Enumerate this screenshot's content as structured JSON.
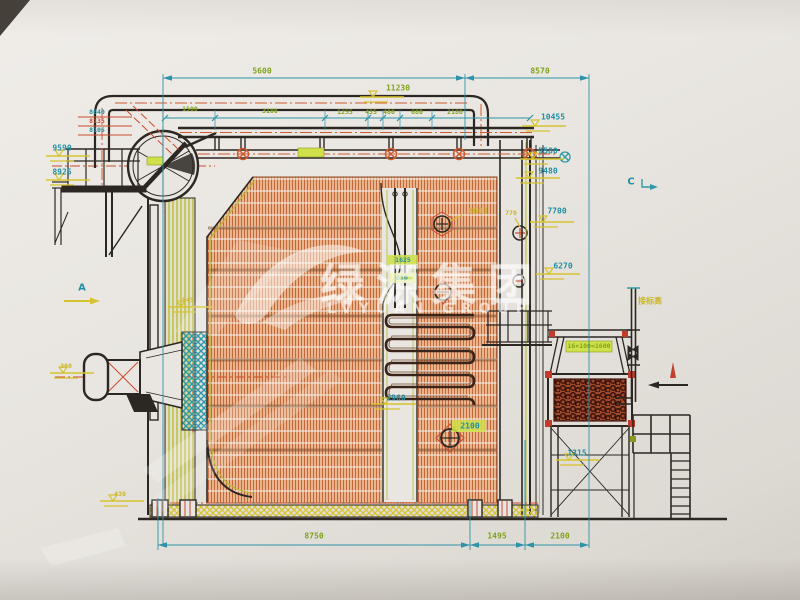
{
  "document": {
    "kind": "engineering-cad-drawing-photo",
    "subject": "boiler side elevation drawing"
  },
  "watermark": {
    "logo": "swoosh-logo",
    "cn": "绿源集团",
    "en": "LVYUAN GROUP"
  },
  "colors": {
    "paper": "#e9e6e1",
    "line_dark": "#2c2722",
    "teal": "#1f8fa3",
    "green": "#7fa31c",
    "yellow": "#c9b62a",
    "red": "#cc4b2e",
    "tube_orange": "#e8b58d",
    "tube_stroke": "#c4683c",
    "coil_dark": "#40120a",
    "olive": "#b5ba30"
  },
  "annotations": [
    {
      "text": "5600",
      "x": 262,
      "y": 71,
      "color": "green"
    },
    {
      "text": "8570",
      "x": 540,
      "y": 71,
      "color": "green"
    },
    {
      "text": "11230",
      "x": 398,
      "y": 88,
      "color": "green"
    },
    {
      "text": "1500",
      "x": 190,
      "y": 109,
      "color": "green",
      "cls": "small"
    },
    {
      "text": "3100",
      "x": 270,
      "y": 111,
      "color": "green",
      "cls": "small"
    },
    {
      "text": "1255",
      "x": 345,
      "y": 112,
      "color": "green",
      "cls": "small"
    },
    {
      "text": "435",
      "x": 371,
      "y": 112,
      "color": "green",
      "cls": "small"
    },
    {
      "text": "480",
      "x": 389,
      "y": 112,
      "color": "green",
      "cls": "small"
    },
    {
      "text": "680",
      "x": 417,
      "y": 112,
      "color": "green",
      "cls": "small"
    },
    {
      "text": "2180",
      "x": 455,
      "y": 112,
      "color": "green",
      "cls": "small"
    },
    {
      "text": "10455",
      "x": 553,
      "y": 117,
      "color": "teal"
    },
    {
      "text": "9580",
      "x": 548,
      "y": 151,
      "color": "teal"
    },
    {
      "text": "9480",
      "x": 548,
      "y": 171,
      "color": "teal"
    },
    {
      "text": "7700",
      "x": 557,
      "y": 211,
      "color": "teal"
    },
    {
      "text": "770",
      "x": 511,
      "y": 213,
      "color": "yellow",
      "cls": "small"
    },
    {
      "text": "8603",
      "x": 478,
      "y": 211,
      "color": "yellow"
    },
    {
      "text": "6270",
      "x": 563,
      "y": 266,
      "color": "teal"
    },
    {
      "text": "8640",
      "x": 97,
      "y": 112,
      "color": "teal",
      "cls": "small"
    },
    {
      "text": "8135",
      "x": 97,
      "y": 121,
      "color": "red",
      "cls": "small"
    },
    {
      "text": "8105",
      "x": 97,
      "y": 130,
      "color": "teal",
      "cls": "small"
    },
    {
      "text": "9590",
      "x": 62,
      "y": 148,
      "color": "teal"
    },
    {
      "text": "8925",
      "x": 62,
      "y": 172,
      "color": "teal"
    },
    {
      "text": "A",
      "x": 82,
      "y": 288,
      "color": "teal",
      "cls": "marker",
      "name": "view-marker-a"
    },
    {
      "text": "C",
      "x": 631,
      "y": 182,
      "color": "teal",
      "cls": "marker",
      "name": "view-marker-c"
    },
    {
      "text": "380",
      "x": 66,
      "y": 366,
      "color": "yellow",
      "cls": "small"
    },
    {
      "text": "545",
      "x": 188,
      "y": 300,
      "color": "yellow",
      "cls": "small"
    },
    {
      "text": "430",
      "x": 120,
      "y": 494,
      "color": "yellow",
      "cls": "small"
    },
    {
      "text": "1625",
      "x": 403,
      "y": 260,
      "color": "teal",
      "cls": "small"
    },
    {
      "text": "610",
      "x": 402,
      "y": 278,
      "color": "teal",
      "cls": "small"
    },
    {
      "text": "2960",
      "x": 396,
      "y": 398,
      "color": "teal"
    },
    {
      "text": "2100",
      "x": 470,
      "y": 426,
      "color": "teal"
    },
    {
      "text": "1315",
      "x": 577,
      "y": 453,
      "color": "teal"
    },
    {
      "text": "16×100=1600",
      "x": 589,
      "y": 346,
      "color": "green",
      "cls": "small"
    },
    {
      "text": "接标高",
      "x": 650,
      "y": 301,
      "color": "yellow"
    },
    {
      "text": "8750",
      "x": 314,
      "y": 536,
      "color": "green"
    },
    {
      "text": "1495",
      "x": 497,
      "y": 536,
      "color": "green"
    },
    {
      "text": "2100",
      "x": 560,
      "y": 536,
      "color": "green"
    }
  ]
}
